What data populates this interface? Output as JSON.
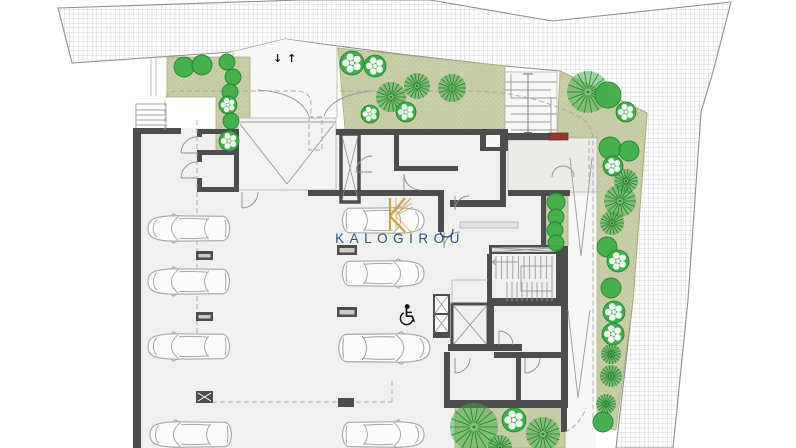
{
  "document": {
    "type": "architectural floor plan",
    "level": "basement parking / ground site plan"
  },
  "watermark": {
    "brand": "KALOGIROU",
    "logo_icon": "k-monogram-icon"
  },
  "ramp_arrows": {
    "down": "↓",
    "up": "↑"
  },
  "icons": [
    {
      "name": "wheelchair-icon"
    },
    {
      "name": "k-monogram-icon"
    },
    {
      "name": "down-arrow-icon"
    },
    {
      "name": "up-arrow-icon"
    }
  ],
  "colors": {
    "floor": "#f0f0ee",
    "white_area": "#f7f7f5",
    "olive": "#c9cda5",
    "olive_dot": "#b5ba90",
    "tree_green": "#3fae4a",
    "tree_dark": "#218232",
    "wall": "#4d4d4d",
    "hatch_line": "#c5c9c3",
    "red_mat": "#993527",
    "car_line": "#a7a7a5",
    "wm_blue": "#2b4a7a",
    "wm_gold": "#c9a24b"
  },
  "trees": [
    {
      "type": "solid",
      "x": 184,
      "y": 67,
      "r": 10
    },
    {
      "type": "solid",
      "x": 202,
      "y": 65,
      "r": 10
    },
    {
      "type": "solid",
      "x": 227,
      "y": 62,
      "r": 8
    },
    {
      "type": "solid",
      "x": 233,
      "y": 77,
      "r": 8
    },
    {
      "type": "solid",
      "x": 230,
      "y": 92,
      "r": 8
    },
    {
      "type": "scallop",
      "x": 228,
      "y": 105,
      "r": 9
    },
    {
      "type": "solid",
      "x": 231,
      "y": 121,
      "r": 8
    },
    {
      "type": "scallop",
      "x": 229,
      "y": 141,
      "r": 10
    },
    {
      "type": "scallop",
      "x": 352,
      "y": 63,
      "r": 12
    },
    {
      "type": "scallop",
      "x": 375,
      "y": 66,
      "r": 11
    },
    {
      "type": "burst",
      "x": 391,
      "y": 97,
      "r": 15
    },
    {
      "type": "scallop",
      "x": 370,
      "y": 114,
      "r": 9
    },
    {
      "type": "burst",
      "x": 417,
      "y": 86,
      "r": 13
    },
    {
      "type": "burst",
      "x": 452,
      "y": 88,
      "r": 14
    },
    {
      "type": "scallop",
      "x": 406,
      "y": 112,
      "r": 10
    },
    {
      "type": "burst",
      "x": 588,
      "y": 92,
      "r": 21
    },
    {
      "type": "solid",
      "x": 608,
      "y": 95,
      "r": 13
    },
    {
      "type": "scallop",
      "x": 626,
      "y": 112,
      "r": 10
    },
    {
      "type": "solid",
      "x": 610,
      "y": 148,
      "r": 11
    },
    {
      "type": "solid",
      "x": 629,
      "y": 151,
      "r": 10
    },
    {
      "type": "scallop",
      "x": 613,
      "y": 166,
      "r": 10
    },
    {
      "type": "burst",
      "x": 626,
      "y": 181,
      "r": 12
    },
    {
      "type": "burst",
      "x": 620,
      "y": 201,
      "r": 16
    },
    {
      "type": "burst",
      "x": 612,
      "y": 223,
      "r": 12
    },
    {
      "type": "solid",
      "x": 607,
      "y": 247,
      "r": 10
    },
    {
      "type": "scallop",
      "x": 618,
      "y": 261,
      "r": 11
    },
    {
      "type": "solid",
      "x": 611,
      "y": 288,
      "r": 10
    },
    {
      "type": "scallop",
      "x": 614,
      "y": 312,
      "r": 11
    },
    {
      "type": "scallop",
      "x": 613,
      "y": 334,
      "r": 11
    },
    {
      "type": "burst",
      "x": 611,
      "y": 354,
      "r": 10
    },
    {
      "type": "burst",
      "x": 611,
      "y": 376,
      "r": 11
    },
    {
      "type": "burst",
      "x": 606,
      "y": 404,
      "r": 10
    },
    {
      "type": "solid",
      "x": 603,
      "y": 422,
      "r": 10
    },
    {
      "type": "solid",
      "x": 556,
      "y": 202,
      "r": 9
    },
    {
      "type": "solid",
      "x": 556,
      "y": 217,
      "r": 8
    },
    {
      "type": "solid",
      "x": 555,
      "y": 230,
      "r": 8
    },
    {
      "type": "solid",
      "x": 556,
      "y": 243,
      "r": 8
    },
    {
      "type": "burst",
      "x": 474,
      "y": 427,
      "r": 24
    },
    {
      "type": "scallop",
      "x": 514,
      "y": 420,
      "r": 12
    },
    {
      "type": "burst",
      "x": 543,
      "y": 434,
      "r": 17
    },
    {
      "type": "burst",
      "x": 500,
      "y": 447,
      "r": 12
    }
  ],
  "cars": [
    {
      "x": 146,
      "y": 213,
      "dir": "left"
    },
    {
      "x": 146,
      "y": 266,
      "dir": "left"
    },
    {
      "x": 146,
      "y": 331,
      "dir": "left"
    },
    {
      "x": 148,
      "y": 419,
      "dir": "left"
    },
    {
      "x": 340,
      "y": 205,
      "dir": "right"
    },
    {
      "x": 340,
      "y": 258,
      "dir": "right"
    },
    {
      "x": 336,
      "y": 330,
      "dir": "right",
      "w": 96,
      "h": 36
    },
    {
      "x": 340,
      "y": 419,
      "dir": "right"
    }
  ],
  "pillars": [
    {
      "x": 196,
      "y": 251,
      "w": 17,
      "h": 9,
      "style": "slot"
    },
    {
      "x": 196,
      "y": 312,
      "w": 17,
      "h": 9,
      "style": "slot"
    },
    {
      "x": 196,
      "y": 391,
      "w": 17,
      "h": 12,
      "style": "x"
    },
    {
      "x": 337,
      "y": 245,
      "w": 20,
      "h": 10,
      "style": "slot"
    },
    {
      "x": 337,
      "y": 307,
      "w": 20,
      "h": 10,
      "style": "slot"
    },
    {
      "x": 338,
      "y": 398,
      "w": 16,
      "h": 9,
      "style": "plain"
    }
  ]
}
